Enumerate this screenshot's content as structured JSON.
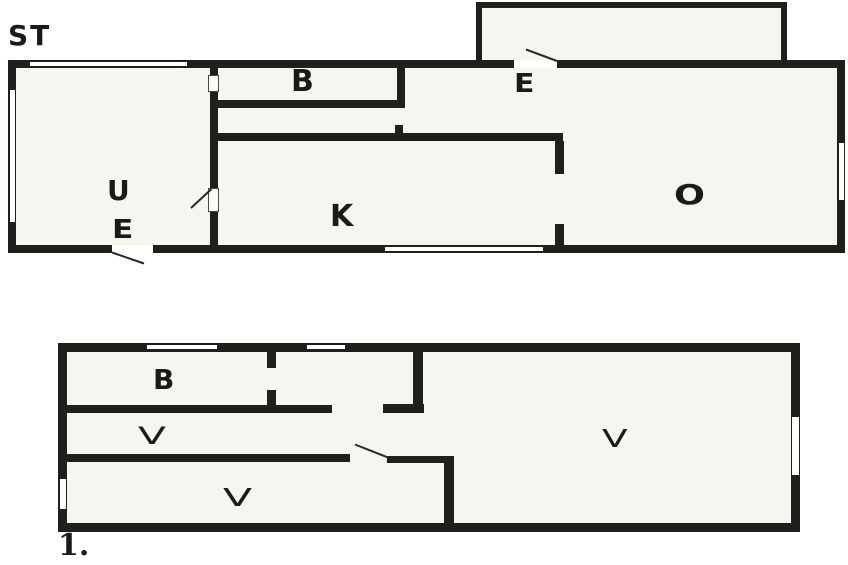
{
  "upper_plan": {
    "title": "ST",
    "room_labels": {
      "b": "B",
      "e_entrance": "E",
      "u": "U",
      "e_hall": "E",
      "k": "K",
      "o": "O"
    }
  },
  "lower_plan": {
    "title": "1.",
    "room_labels": {
      "b": "B",
      "v_middle": "V",
      "v_bottom": "V",
      "v_large": "V"
    }
  },
  "colors": {
    "wall": "#211f1c",
    "floor": "#f7f5f0",
    "background": "#ffffff",
    "line": "#2b2927"
  }
}
